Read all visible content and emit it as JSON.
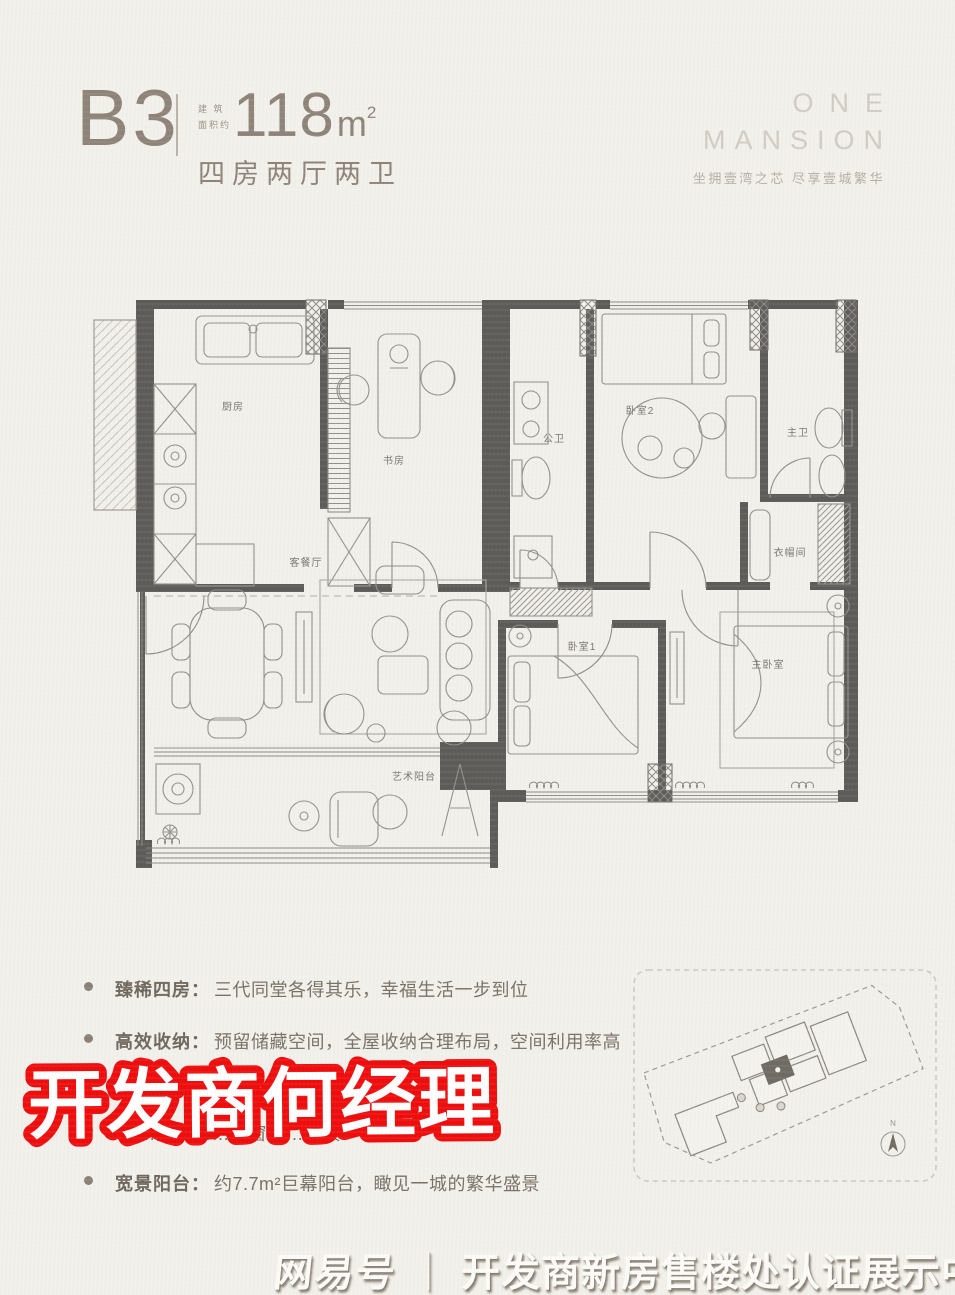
{
  "header": {
    "unit": "B3",
    "area_note_line1": "建 筑",
    "area_note_line2": "面积约",
    "area_value": "118",
    "area_unit": "m",
    "area_sup": "2",
    "layout": "四房两厅两卫"
  },
  "brand": {
    "line1": "ONE",
    "line2": "MANSION",
    "tagline": "坐拥壹湾之芯  尽享壹城繁华"
  },
  "floorplan": {
    "rooms": {
      "kitchen": "厨房",
      "study": "书房",
      "guest_bath": "公卫",
      "bedroom2": "卧室2",
      "master_bath": "主卫",
      "living_dining": "客餐厅",
      "art_balcony": "艺术阳台",
      "bedroom1": "卧室1",
      "master_bedroom": "主卧室",
      "cloakroom": "衣帽间"
    }
  },
  "features": [
    {
      "label": "臻稀四房：",
      "text": "三代同堂各得其乐，幸福生活一步到位"
    },
    {
      "label": "高效收纳：",
      "text": "预留储藏空间，全屋收纳合理布局，空间利用率高"
    },
    {
      "label": "",
      "text": "……通风……推窗……美景"
    },
    {
      "label": "宽景阳台：",
      "text": "约7.7m²巨幕阳台，瞰见一城的繁华盛景"
    }
  ],
  "sticker": {
    "text": "开发商何经理",
    "red": "#ee0d0d"
  },
  "siteplan": {
    "north_label": "N"
  },
  "footer": {
    "brand": "网易号",
    "separator": "｜",
    "text": "开发商新房售楼处认证展示中心"
  }
}
